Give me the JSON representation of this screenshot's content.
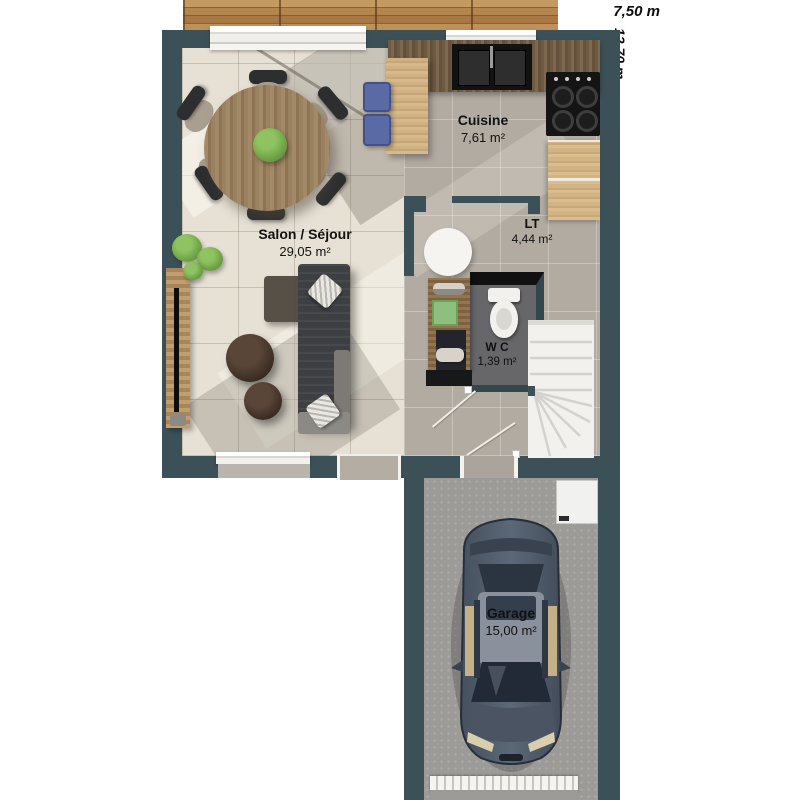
{
  "plan": {
    "dims": {
      "width": "7,50 m",
      "height": "12,70 m"
    },
    "rooms": [
      {
        "name": "Cuisine",
        "area": "7,61 m²"
      },
      {
        "name": "Salon / Séjour",
        "area": "29,05 m²"
      },
      {
        "name": "LT",
        "area": "4,44 m²"
      },
      {
        "name": "W C",
        "area": "1,39 m²"
      },
      {
        "name": "Garage",
        "area": "15,00 m²"
      }
    ],
    "colors": {
      "wall": "#3c5157",
      "salon_floor": "#e7e1d5",
      "gray_floor": "#b2aba2",
      "wc_floor": "#67676a",
      "garage_floor": "#9c9b98",
      "deck_wood": "#b3854f",
      "counter_wood_dark": "#6e5a43",
      "cabinet_wood_light": "#d2b383",
      "sofa": "#3e3f42",
      "car_body": "#4f5a6a",
      "stool_blue": "#5a6aa4",
      "plant_green": "#76ab4d",
      "stairs_white": "#f2f1ee"
    }
  }
}
